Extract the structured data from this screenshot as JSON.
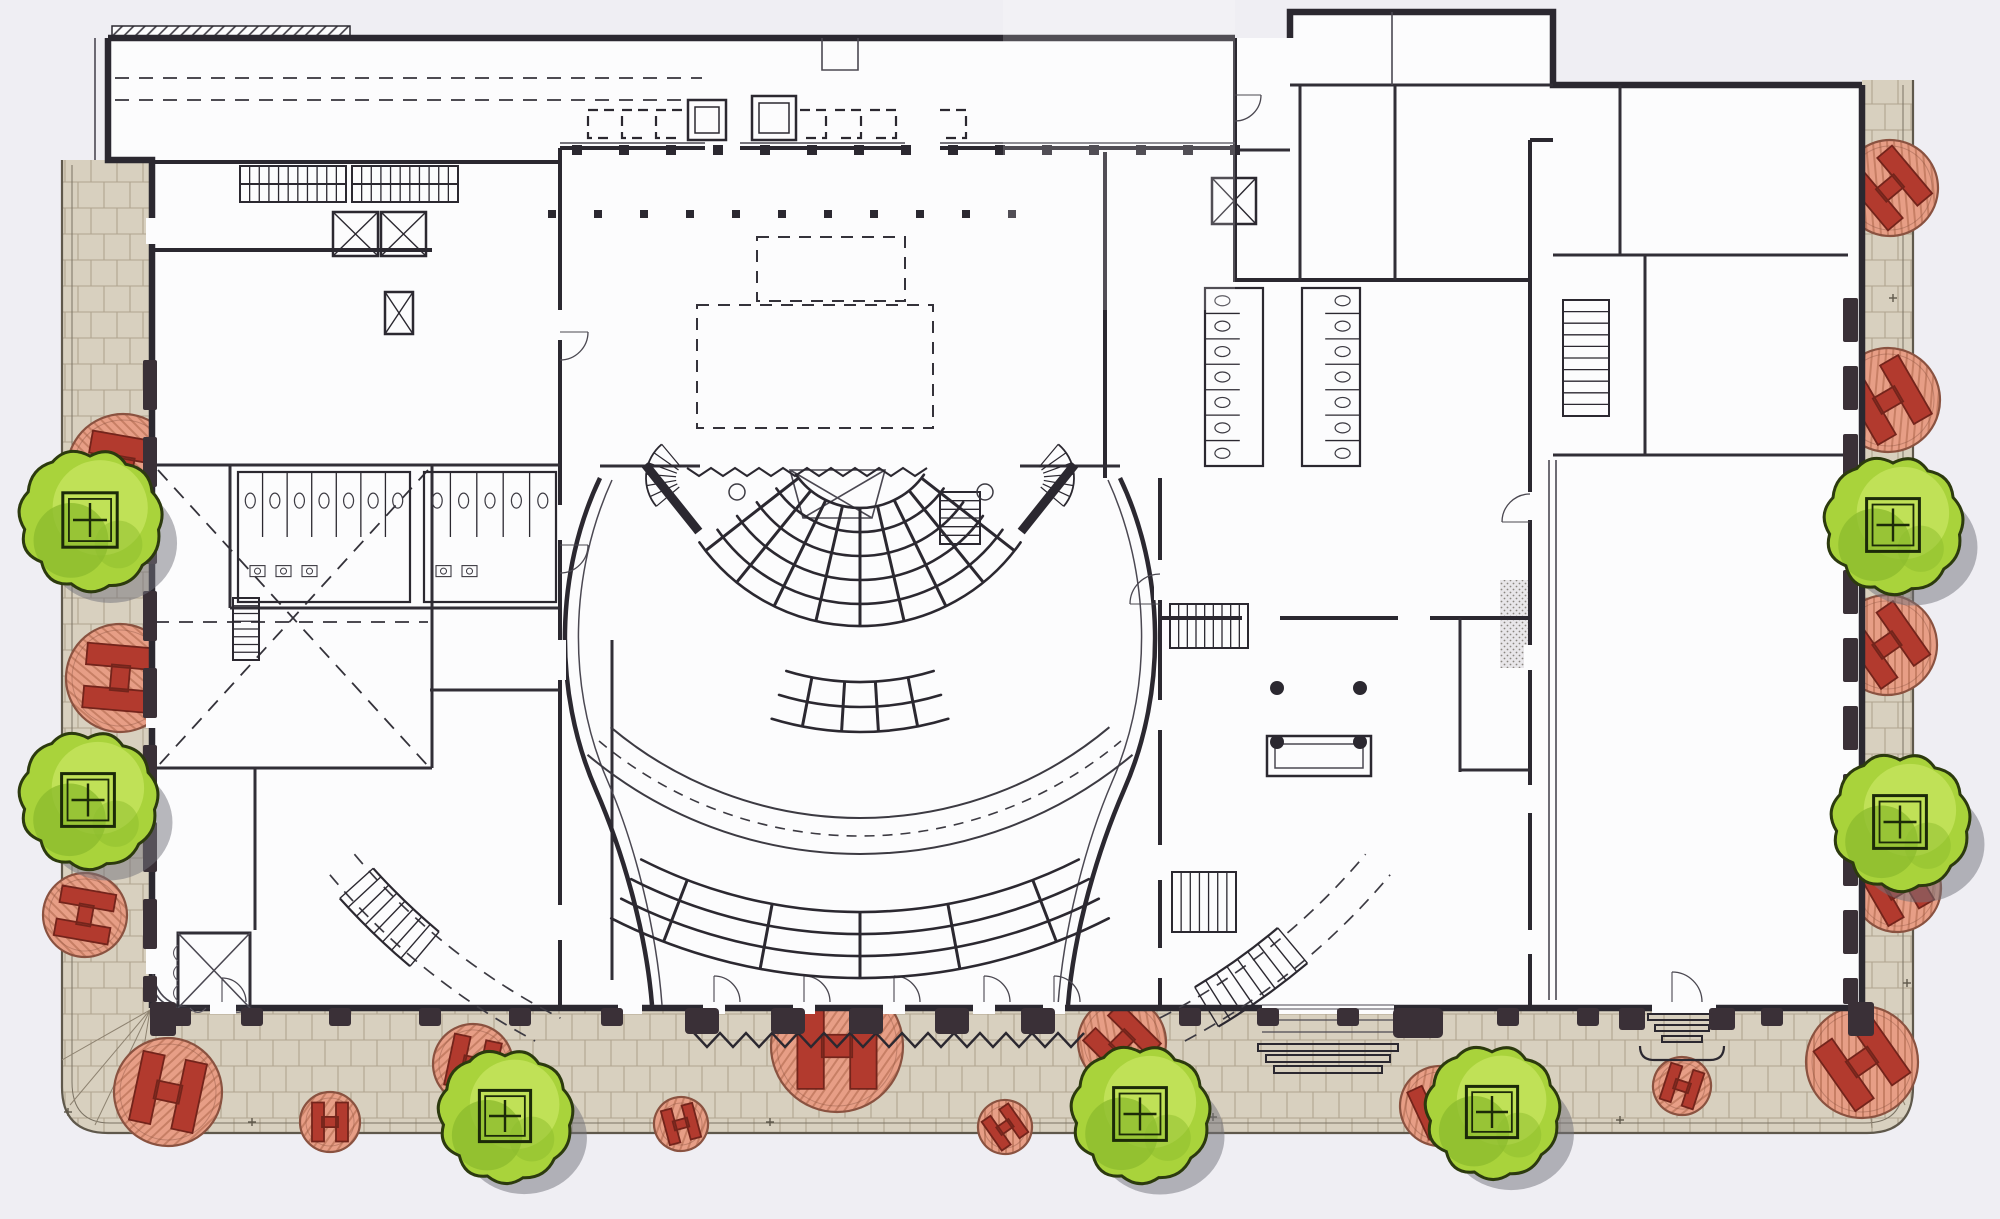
{
  "scene": {
    "width": 2000,
    "height": 1219,
    "background": "#efeef3",
    "paper": "#fcfcfd"
  },
  "palette": {
    "wall": "#2b2830",
    "wallMedium": "#45424a",
    "pier": "#3a3037",
    "paving": "#d8d0bf",
    "pavingLine": "#a0927b",
    "pavingEdge": "#5f584b",
    "treeGreen": "#a9d33b",
    "treeLight": "#c8e561",
    "treeDark": "#8dbd2e",
    "treeOutline": "#2c3a0e",
    "shadow": "#71717c",
    "medallionFill": "#e79e86",
    "medallionHatch": "#c77f65",
    "medallionEdge": "#8a5240",
    "hFill": "#b23a2e",
    "hEdge": "#73241b",
    "detail": "#4a4750",
    "stipple": "#8a8580"
  },
  "landscape": {
    "trees": [
      {
        "x": 90,
        "y": 520,
        "r": 68
      },
      {
        "x": 88,
        "y": 800,
        "r": 66
      },
      {
        "x": 505,
        "y": 1116,
        "r": 64
      },
      {
        "x": 1140,
        "y": 1114,
        "r": 66
      },
      {
        "x": 1492,
        "y": 1112,
        "r": 64
      },
      {
        "x": 1893,
        "y": 525,
        "r": 66
      },
      {
        "x": 1900,
        "y": 822,
        "r": 66
      }
    ],
    "medallions": [
      {
        "x": 123,
        "y": 470,
        "r": 56,
        "a": 100
      },
      {
        "x": 120,
        "y": 678,
        "r": 54,
        "a": 95
      },
      {
        "x": 85,
        "y": 915,
        "r": 42,
        "a": 100
      },
      {
        "x": 168,
        "y": 1092,
        "r": 54,
        "a": 12
      },
      {
        "x": 330,
        "y": 1122,
        "r": 30,
        "a": 0
      },
      {
        "x": 473,
        "y": 1064,
        "r": 40,
        "a": 12
      },
      {
        "x": 681,
        "y": 1124,
        "r": 27,
        "a": -15
      },
      {
        "x": 837,
        "y": 1046,
        "r": 66,
        "a": 0
      },
      {
        "x": 1005,
        "y": 1127,
        "r": 27,
        "a": -35
      },
      {
        "x": 1122,
        "y": 1042,
        "r": 44,
        "a": -45
      },
      {
        "x": 1440,
        "y": 1106,
        "r": 40,
        "a": -25
      },
      {
        "x": 1682,
        "y": 1086,
        "r": 29,
        "a": 18
      },
      {
        "x": 1862,
        "y": 1062,
        "r": 56,
        "a": -35
      },
      {
        "x": 1890,
        "y": 188,
        "r": 48,
        "a": -40
      },
      {
        "x": 1888,
        "y": 400,
        "r": 52,
        "a": -30
      },
      {
        "x": 1887,
        "y": 645,
        "r": 50,
        "a": -35
      },
      {
        "x": 1897,
        "y": 888,
        "r": 44,
        "a": -30
      }
    ],
    "pavementStars": [
      [
        82,
        492
      ],
      [
        80,
        675
      ],
      [
        252,
        1122
      ],
      [
        770,
        1122
      ],
      [
        1213,
        1117
      ],
      [
        1620,
        1120
      ],
      [
        1907,
        685
      ],
      [
        1907,
        983
      ],
      [
        1893,
        298
      ],
      [
        68,
        1112
      ]
    ],
    "cornerFansSW": [
      [
        [
          150,
          1010
        ],
        [
          62,
          1060
        ]
      ],
      [
        [
          150,
          1010
        ],
        [
          70,
          1105
        ]
      ],
      [
        [
          150,
          1010
        ],
        [
          95,
          1125
        ]
      ],
      [
        [
          150,
          1010
        ],
        [
          130,
          1133
        ]
      ]
    ],
    "cornerFansSE": [
      [
        [
          1860,
          1010
        ],
        [
          1913,
          1062
        ]
      ],
      [
        [
          1860,
          1010
        ],
        [
          1905,
          1105
        ]
      ],
      [
        [
          1860,
          1010
        ],
        [
          1872,
          1128
        ]
      ]
    ]
  },
  "facade": {
    "southPierY": 1008,
    "boldPiers": [
      702,
      788,
      866,
      952,
      1038
    ],
    "mediumPiers": [
      180,
      252,
      340,
      430,
      520,
      612,
      1190,
      1268,
      1348,
      1508,
      1588,
      1772
    ],
    "porticoPiers": [
      1418
    ],
    "flankPiers": [
      1632,
      1722
    ],
    "cornerBlocks": [
      [
        150,
        1002,
        26,
        34
      ],
      [
        1848,
        1002,
        26,
        34
      ]
    ],
    "windowBars": [
      {
        "x": 143,
        "w": 14,
        "y0": 360,
        "y1": 1002,
        "seg": 50,
        "gap": 27
      },
      {
        "x": 1843,
        "w": 15,
        "y0": 298,
        "y1": 1004,
        "seg": 44,
        "gap": 24
      }
    ],
    "colonnades": [
      {
        "y": 145,
        "x0": 572,
        "step": 47,
        "n": 15,
        "s": 10
      },
      {
        "y": 210,
        "x0": 548,
        "step": 46,
        "n": 11,
        "s": 8
      }
    ],
    "zigzagMat": {
      "x0": 694,
      "x1": 1092,
      "y": 1040,
      "amp": 7,
      "period": 26
    }
  },
  "doorGaps": [
    [
      703,
      1002,
      22,
      12
    ],
    [
      793,
      1002,
      22,
      12
    ],
    [
      883,
      1002,
      22,
      12
    ],
    [
      973,
      1002,
      22,
      12
    ],
    [
      1043,
      1002,
      22,
      12
    ],
    [
      210,
      1002,
      26,
      12
    ],
    [
      618,
      1002,
      24,
      12
    ],
    [
      1262,
      1002,
      132,
      12
    ],
    [
      1652,
      1002,
      64,
      12
    ],
    [
      146,
      218,
      12,
      26
    ],
    [
      146,
      700,
      12,
      28
    ],
    [
      146,
      948,
      12,
      26
    ],
    [
      554,
      310,
      12,
      30
    ],
    [
      554,
      505,
      12,
      35
    ],
    [
      554,
      640,
      12,
      40
    ],
    [
      554,
      905,
      12,
      35
    ],
    [
      1154,
      560,
      12,
      40
    ],
    [
      1154,
      700,
      12,
      30
    ],
    [
      1154,
      845,
      12,
      35
    ],
    [
      1154,
      948,
      12,
      30
    ],
    [
      1524,
      492,
      12,
      28
    ],
    [
      1524,
      645,
      12,
      25
    ],
    [
      1524,
      785,
      12,
      28
    ],
    [
      1524,
      930,
      12,
      24
    ],
    [
      1242,
      612,
      38,
      12
    ],
    [
      1398,
      612,
      32,
      12
    ],
    [
      705,
      142,
      35,
      12
    ],
    [
      905,
      142,
      35,
      12
    ]
  ],
  "doorArcs": [
    [
      714,
      1002,
      26,
      2
    ],
    [
      804,
      1002,
      26,
      2
    ],
    [
      894,
      1002,
      26,
      2
    ],
    [
      984,
      1002,
      26,
      2
    ],
    [
      1054,
      1002,
      26,
      2
    ],
    [
      222,
      1002,
      24,
      2
    ],
    [
      560,
      332,
      28,
      3
    ],
    [
      560,
      545,
      28,
      3
    ],
    [
      1160,
      604,
      30,
      1
    ],
    [
      1530,
      522,
      28,
      1
    ],
    [
      1672,
      1002,
      30,
      2
    ],
    [
      1235,
      95,
      26,
      3
    ]
  ],
  "auditorium": {
    "center": [
      860,
      430
    ],
    "sections": [
      {
        "radii": [
          78,
          102,
          126,
          150,
          174,
          196
        ],
        "span": 55,
        "dividers": [
          -52,
          -39,
          -26,
          -13,
          0,
          13,
          26,
          39,
          52
        ]
      },
      {
        "radii": [
          252,
          277,
          302
        ],
        "span": 17,
        "dividers": [
          -11,
          -3.5,
          3.5,
          11
        ]
      },
      {
        "radii": [
          482,
          504,
          526,
          548
        ],
        "span": 27,
        "dividers": [
          -21,
          -10.5,
          0,
          10.5,
          21
        ]
      }
    ],
    "crossAisle": {
      "solid": [
        388,
        424
      ],
      "dashed": [
        406
      ],
      "span": 40
    },
    "promenadeDashes": [
      {
        "r": 660,
        "a0": -50,
        "a1": -27
      },
      {
        "r": 692,
        "a0": -50,
        "a1": -28
      },
      {
        "r": 660,
        "a0": 27,
        "a1": 50
      },
      {
        "r": 692,
        "a0": 28,
        "a1": 50
      }
    ],
    "curvedStairs": [
      {
        "r0": 655,
        "r1": 700,
        "a0": -48,
        "a1": -40,
        "treads": 8
      },
      {
        "r0": 650,
        "r1": 696,
        "a0": 31,
        "a1": 40,
        "treads": 8
      }
    ],
    "stageFans": [
      {
        "cx": 690,
        "cy": 478,
        "r0": 14,
        "r1": 44,
        "a0": -140,
        "a1": -50,
        "treads": 6
      },
      {
        "cx": 1030,
        "cy": 478,
        "r0": 14,
        "r1": 44,
        "a0": 50,
        "a1": 140,
        "treads": 6
      }
    ],
    "markers": [
      [
        737,
        492
      ],
      [
        985,
        492
      ]
    ]
  },
  "stairs": [
    {
      "x": 240,
      "y": 166,
      "w": 106,
      "h": 36,
      "n": 11,
      "dir": "h"
    },
    {
      "x": 352,
      "y": 166,
      "w": 106,
      "h": 36,
      "n": 11,
      "dir": "h"
    },
    {
      "x": 233,
      "y": 598,
      "w": 26,
      "h": 62,
      "n": 8,
      "dir": "v"
    },
    {
      "x": 1170,
      "y": 604,
      "w": 78,
      "h": 44,
      "n": 9,
      "dir": "h"
    },
    {
      "x": 1172,
      "y": 872,
      "w": 64,
      "h": 60,
      "n": 7,
      "dir": "h"
    },
    {
      "x": 1563,
      "y": 300,
      "w": 46,
      "h": 116,
      "n": 10,
      "dir": "v"
    },
    {
      "x": 940,
      "y": 492,
      "w": 40,
      "h": 52,
      "n": 6,
      "dir": "v"
    }
  ],
  "elevators": [
    [
      333,
      212,
      45,
      44
    ],
    [
      381,
      212,
      45,
      44
    ],
    [
      385,
      292,
      28,
      42
    ],
    [
      1212,
      178,
      44,
      46
    ]
  ],
  "restrooms": [
    {
      "x": 238,
      "y": 472,
      "w": 172,
      "h": 130,
      "stalls": 7,
      "dir": "v"
    },
    {
      "x": 424,
      "y": 472,
      "w": 132,
      "h": 130,
      "stalls": 5,
      "dir": "v"
    },
    {
      "x": 1205,
      "y": 288,
      "w": 58,
      "h": 178,
      "stalls": 7,
      "dir": "hR"
    },
    {
      "x": 1302,
      "y": 288,
      "w": 58,
      "h": 178,
      "stalls": 7,
      "dir": "hL"
    }
  ],
  "dashedLines": [
    [
      115,
      78,
      702,
      78
    ],
    [
      115,
      100,
      702,
      100
    ],
    [
      155,
      622,
      428,
      622
    ],
    [
      158,
      470,
      428,
      766
    ],
    [
      428,
      470,
      158,
      766
    ]
  ],
  "dashedRects": [
    [
      757,
      237,
      148,
      64
    ],
    [
      697,
      305,
      236,
      123
    ]
  ],
  "platforms": {
    "boxes": [
      [
        688,
        100,
        38,
        40
      ],
      [
        752,
        96,
        44,
        44
      ]
    ],
    "bracketsLeft": [
      588,
      622,
      656
    ],
    "bracketsRight": [
      800,
      835,
      870,
      940
    ],
    "bracketY": 110,
    "bracketH": 28,
    "bracketW": 26
  },
  "lobbyColumns": [
    [
      1277,
      688
    ],
    [
      1360,
      688
    ],
    [
      1277,
      742
    ],
    [
      1360,
      742
    ]
  ],
  "stepsRuns": {
    "wingSouth": [
      [
        1258,
        1044,
        140,
        7
      ],
      [
        1266,
        1055,
        124,
        7
      ],
      [
        1274,
        1066,
        108,
        7
      ]
    ],
    "wingSouthLanding": [
      [
        1262,
        1020,
        132
      ],
      [
        1262,
        1032,
        132
      ]
    ],
    "hallSouth": [
      [
        1648,
        1014,
        68,
        6
      ],
      [
        1655,
        1025,
        54,
        6
      ],
      [
        1662,
        1036,
        40,
        6
      ]
    ]
  }
}
